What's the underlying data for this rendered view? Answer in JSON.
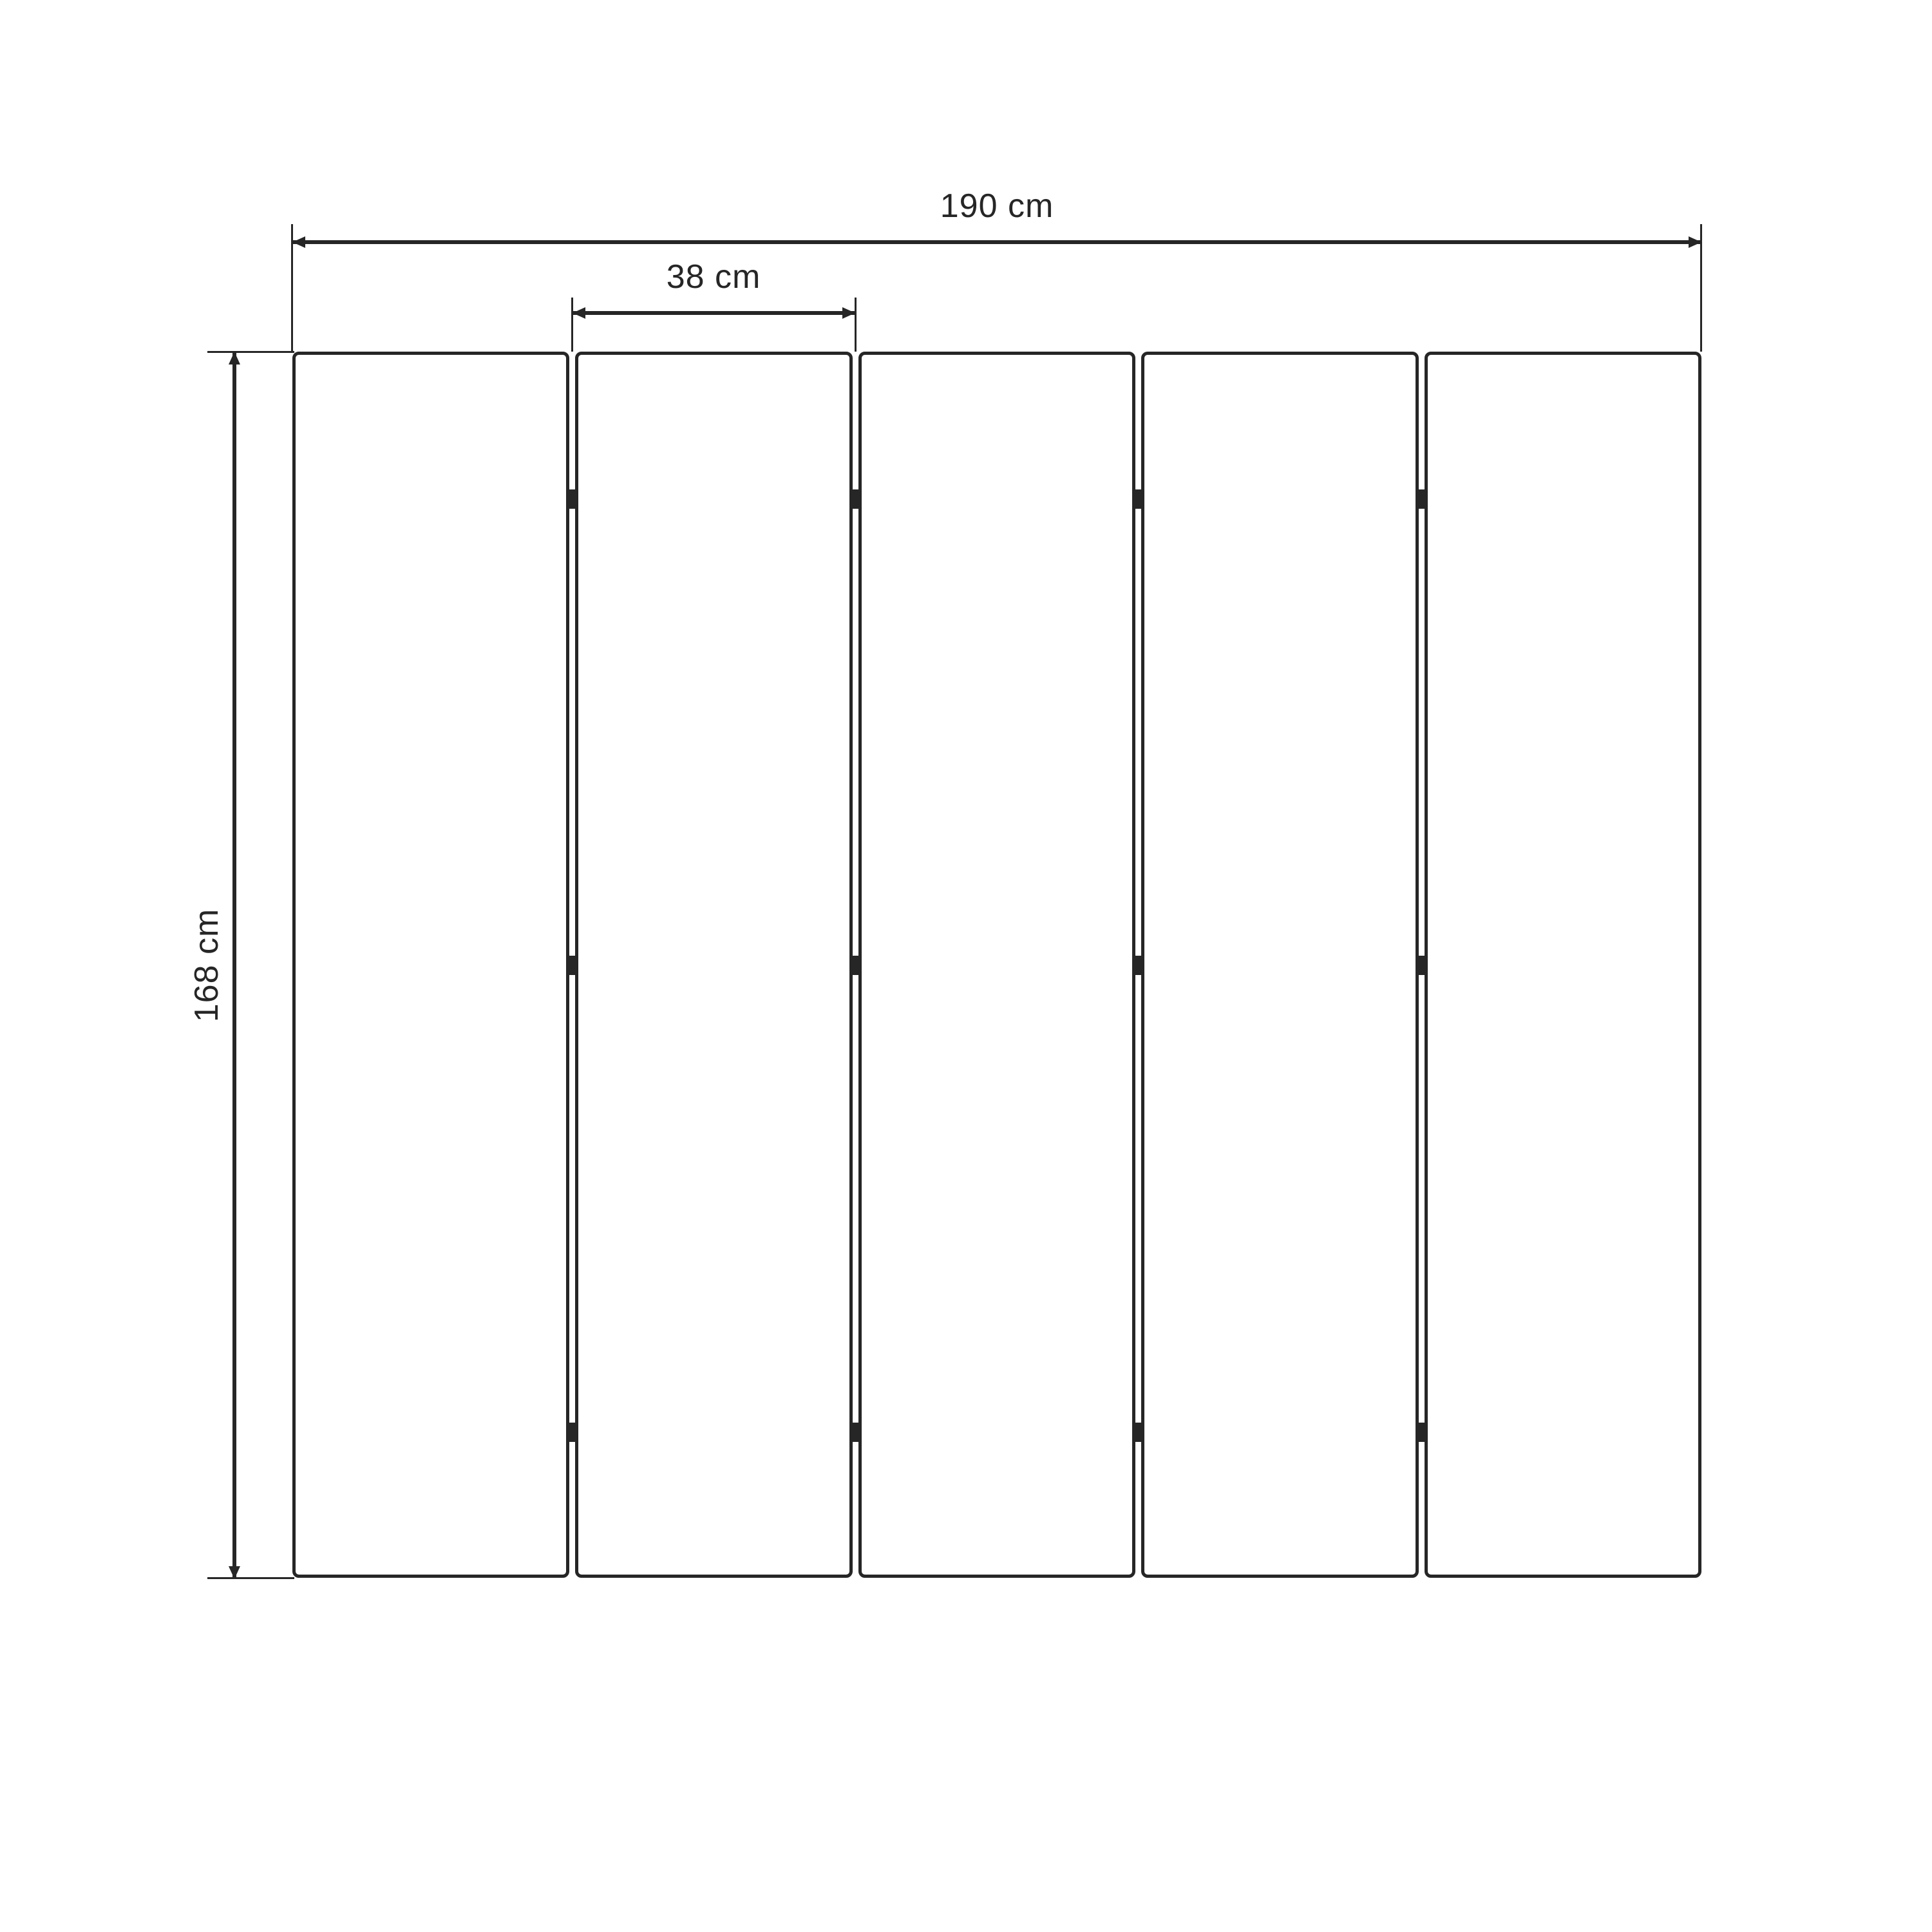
{
  "dimensions": {
    "total_width": {
      "label": "190 cm"
    },
    "panel_width": {
      "label": "38 cm"
    },
    "height": {
      "label": "168 cm"
    }
  },
  "panels": {
    "count": 5,
    "hinge_rows": 3
  },
  "colors": {
    "line": "#262626",
    "background": "#ffffff"
  }
}
